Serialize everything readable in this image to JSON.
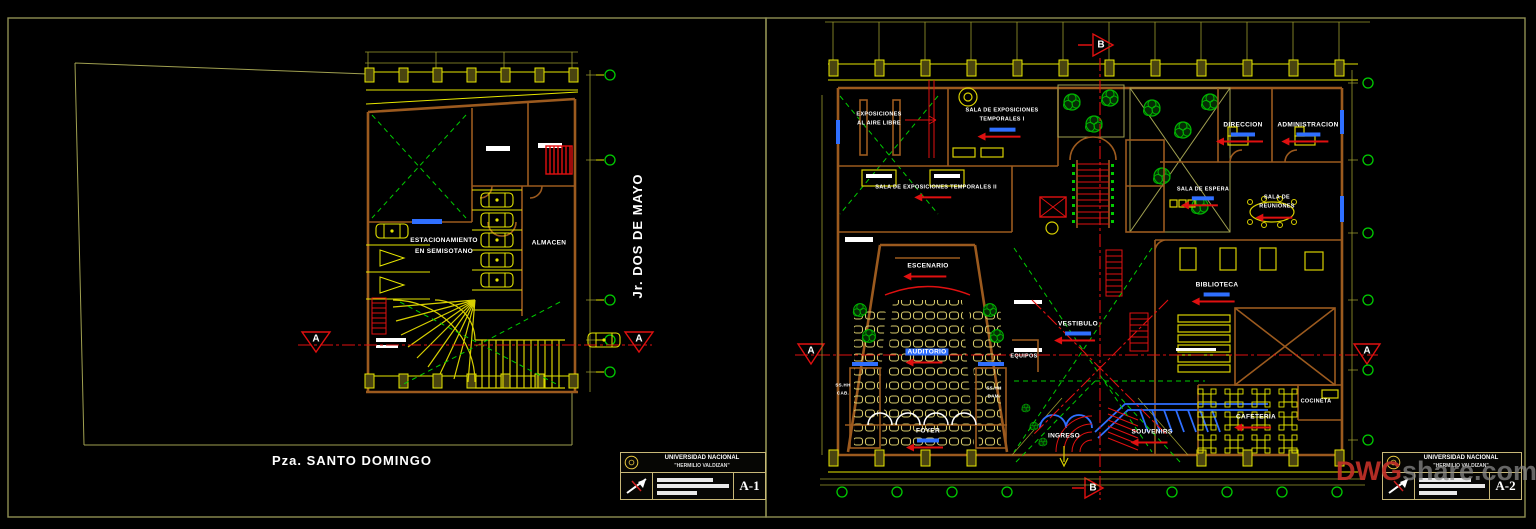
{
  "colors": {
    "background": "#000000",
    "sheet_border": "#8f8f52",
    "wall_brown": "#9c5a1e",
    "cad_yellow": "#e6e600",
    "axis_green": "#00cc00",
    "section_red": "#e01010",
    "detail_blue": "#2f6fff",
    "text_white": "#ffffff"
  },
  "left_sheet": {
    "plaza_label": "Pza. SANTO DOMINGO",
    "street_label": "Jr. DOS DE MAYO",
    "parking_label": "ESTACIONAMIENTO\nEN SEMISOTANO",
    "almacen_label": "ALMACEN",
    "section_letter": "A",
    "titleblock": {
      "university": "UNIVERSIDAD NACIONAL",
      "university2": "\"HERMILIO VALDIZAN\"",
      "sheet_no": "A-1"
    }
  },
  "right_sheet": {
    "rooms": {
      "expo_aire": "EXPOSICIONES\nAL AIRE LIBRE",
      "expo_temp1": "SALA DE EXPOSICIONES\nTEMPORALES I",
      "expo_temp2": "SALA DE EXPOSICIONES TEMPORALES II",
      "direccion": "DIRECCION",
      "administracion": "ADMINISTRACION",
      "sala_espera": "SALA DE ESPERA",
      "sala_reuniones": "SALA DE\nREUNIONES",
      "escenario": "ESCENARIO",
      "auditorio": "AUDITORIO",
      "vestibulo": "VESTIBULO",
      "equipos": "EQUIPOS",
      "biblioteca": "BIBLIOTECA",
      "foyer": "FOYER",
      "ingreso": "INGRESO",
      "souvenirs": "SOUVENIRS",
      "cafeteria": "CAFETERIA",
      "cocineta": "COCINETA",
      "sshh_cab": "SS.HH\nCAB.",
      "sshh_dam": "SS.HH\nDAM."
    },
    "section_letter_a": "A",
    "section_letter_b": "B",
    "titleblock": {
      "university": "UNIVERSIDAD NACIONAL",
      "university2": "\"HERMILIO VALDIZAN\"",
      "sheet_no": "A-2"
    },
    "watermark_prefix": "DWG",
    "watermark_suffix": "share.com"
  }
}
